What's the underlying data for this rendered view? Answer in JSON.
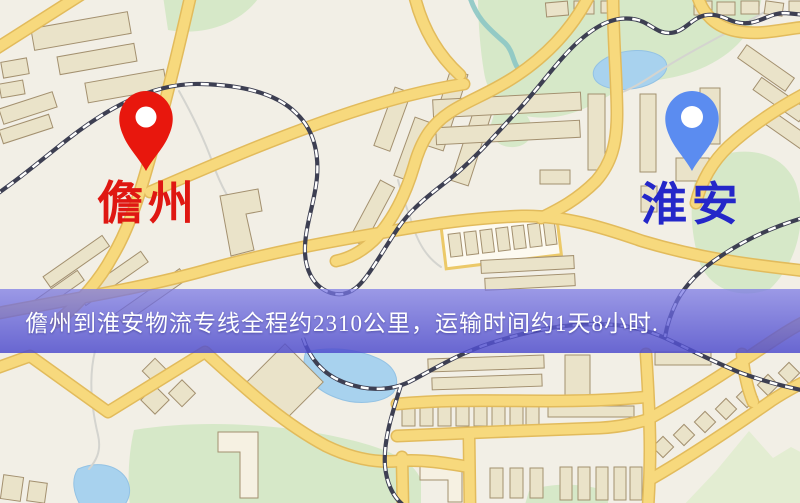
{
  "banner": {
    "text": "儋州到淮安物流专线全程约2310公里，运输时间约1天8小时.",
    "background": "#5f5cd0",
    "text_color": "#ffffff"
  },
  "map": {
    "origin": {
      "label": "儋州",
      "pin_color": "#e8170d",
      "label_color": "#df1712"
    },
    "destination": {
      "label": "淮安",
      "pin_color": "#5b8cf0",
      "label_color": "#2427c9"
    },
    "palette": {
      "background": "#f2efe6",
      "road": "#f7d97d",
      "road_casing": "#e2bb5c",
      "building": "#eae3c9",
      "building_outline": "#a3906f",
      "park": "#d6e8c8",
      "water": "#a8d2ee",
      "railway": "#3d3f52"
    }
  }
}
